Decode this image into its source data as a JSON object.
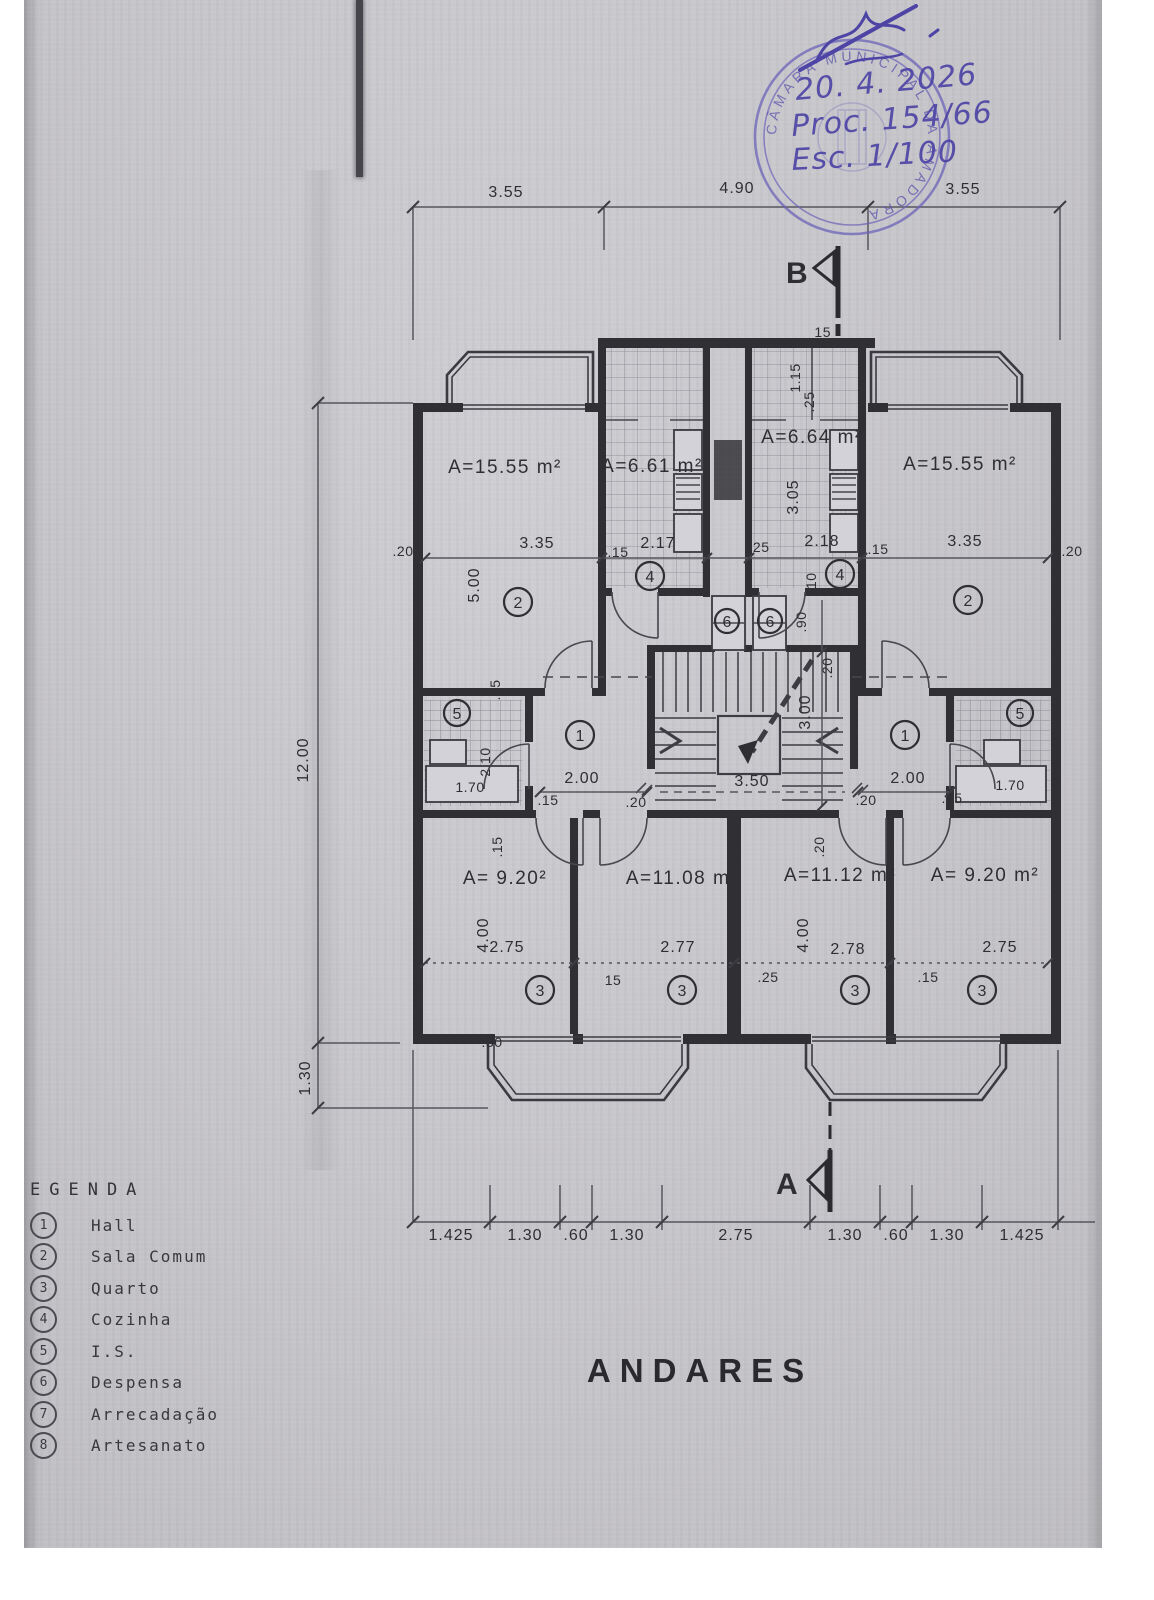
{
  "title": "ANDARES",
  "stamp": {
    "ring_text": "CÂMARA MUNICIPAL DA AMADORA",
    "date": "20. 4. 2026",
    "process": "Proc. 154/66",
    "scale": "Esc. 1/100"
  },
  "markers": {
    "top": "B",
    "bottom": "A"
  },
  "legend": {
    "title": "EGENDA",
    "items": [
      {
        "num": "1",
        "label": "Hall"
      },
      {
        "num": "2",
        "label": "Sala Comum"
      },
      {
        "num": "3",
        "label": "Quarto"
      },
      {
        "num": "4",
        "label": "Cozinha"
      },
      {
        "num": "5",
        "label": "I.S."
      },
      {
        "num": "6",
        "label": "Despensa"
      },
      {
        "num": "7",
        "label": "Arrecadação"
      },
      {
        "num": "8",
        "label": "Artesanato"
      }
    ]
  },
  "room_numbers": {
    "hall": "1",
    "sala": "2",
    "quarto": "3",
    "cozinha": "4",
    "is": "5",
    "despensa": "6"
  },
  "areas": {
    "sala_left": "A=15.55 m²",
    "kitchen_left": "A=6.61 m²",
    "kitchen_right": "A=6.64 m²",
    "sala_right": "A=15.55 m²",
    "quarto1": "A= 9.20²",
    "quarto2": "A=11.08 m²",
    "quarto3": "A=11.12 m²",
    "quarto4": "A= 9.20 m²"
  },
  "dims": {
    "top": [
      "3.55",
      "4.90",
      "3.55"
    ],
    "bottom": [
      "1.425",
      "1.30",
      ".60",
      "1.30",
      "2.75",
      "1.30",
      ".60",
      "1.30",
      "1.425"
    ],
    "left_total": "12.00",
    "left_balcony": "1.30",
    "b_wall": "15",
    "sala_left_w": "3.35",
    "sala_right_w": "3.35",
    "kitchen_left_w": "2.17",
    "kitchen_right_w": "2.18",
    "w20_left": ".20",
    "w20_right": ".20",
    "w15_kitchenL": ".15",
    "w25_kitchenR": ".25",
    "w15_kitchenR": ".15",
    "w10": ".10",
    "sala_h": "5.00",
    "kitchen_h": "3.05",
    "balc_w": "1.15",
    "balc_wall": ".25",
    "despensa_d": ".90",
    "stair_top_wall": ".20",
    "stair_h": "3.00",
    "stair_w": "3.50",
    "hall_w_left": "2.00",
    "hall_w_right": "2.00",
    "hall15_left": ".15",
    "hall15_right": ".15",
    "door20_left": ".20",
    "door20_right": ".20",
    "sala_wall_15": ".15",
    "bath_d": "2.10",
    "bath_w_left": "1.70",
    "bath_w_right": "1.70",
    "q1_w": "2.75",
    "q2_w": "2.77",
    "q3_w": "2.78",
    "q4_w": "2.75",
    "q_h_left": "4.00",
    "q_h_right": "4.00",
    "qwall_15": "15",
    "qwall_25": ".25",
    "qwall_15r": ".15",
    "qwall_15_top": ".15",
    "qwall_20_top": ".20",
    "w30": ".30"
  }
}
